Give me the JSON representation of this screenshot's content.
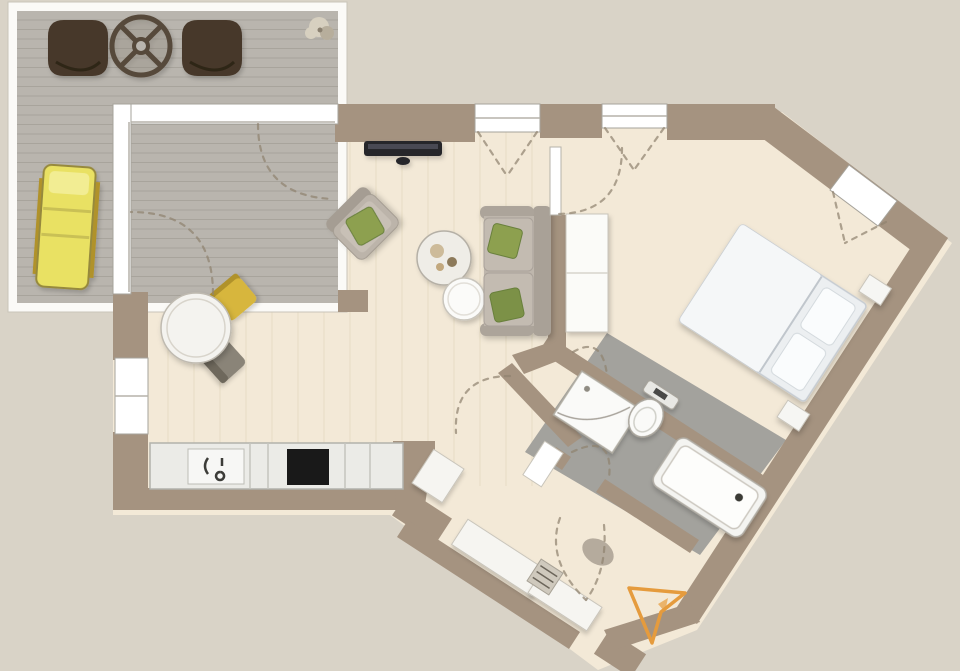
{
  "title": "apartment-floor-plan",
  "plan": {
    "rooms": [
      "terrace",
      "living-dining-room",
      "kitchen",
      "bedroom",
      "bathroom",
      "hallway"
    ],
    "furniture": [
      "deck-chairs",
      "terrace-table",
      "sun-lounger",
      "plant",
      "tv",
      "armchair",
      "coffee-tables",
      "sofa",
      "dining-table",
      "dining-chairs",
      "kitchen-counter",
      "sink",
      "cooktop",
      "wardrobe",
      "double-bed",
      "nightstands",
      "shower",
      "toilet",
      "bathtub",
      "hall-closets",
      "doormat",
      "entrance-arrow"
    ]
  },
  "colors": {
    "bg": "#d9d3c7",
    "terraceFrame": "#fbfaf7",
    "deck": "#b9b5ae",
    "deckLine": "#a8a49c",
    "floor": "#f3e9d7",
    "woodLine": "#e6dac2",
    "wall": "#a59380",
    "bathFloor": "#a3a29d",
    "windowWhite": "#ffffff",
    "dash": "#8f8370",
    "chairBrown": "#463729",
    "tableStroke": "#57493a",
    "loungerYellow": "#e9e164",
    "loungerPad": "#f2ed93",
    "plant1": "#d7d0c0",
    "plant2": "#b7ae9c",
    "tv": "#27272c",
    "armBack": "#a59d93",
    "armBody": "#bcb4aa",
    "armCushion": "#c8c0b6",
    "pillowGreen": "#8da050",
    "pillowGreenDark": "#7b9146",
    "sofaBack": "#a9a197",
    "sofaArm": "#aca49a",
    "sofaBase": "#beb6ac",
    "sofaCushion": "#c3bbb1",
    "coffeeTable1": "#efede7",
    "coffeeTable2": "#fbfbf9",
    "decorTan": "#cdbb9a",
    "decorBrown": "#8d7a5a",
    "diningTable": "#f4f3ef",
    "chairYellow": "#d7b63e",
    "chairYellowBack": "#b0922c",
    "chairGray": "#8a8478",
    "chairGrayBack": "#6e675c",
    "counter": "#ebebe7",
    "sink": "#f7f7f5",
    "cooktop": "#191919",
    "faucet": "#3c3c38",
    "wardrobe": "#fbfbf8",
    "bedBase": "#eceff1",
    "bedDuvet": "#f5f7f8",
    "bedHead": "#e4e8eb",
    "bedPillow": "#fafcfd",
    "nightstand": "#f6f6f3",
    "fixtureWhite": "#fafaf8",
    "tubInner": "#fdfdfb",
    "drain": "#3a3a36",
    "closet": "#f6f5f1",
    "mat": "#a9a093",
    "bench": "#cfc9bd",
    "benchLine": "#6b655a",
    "doorLeaf": "#ffffff",
    "arrow": "#e59b3d"
  }
}
